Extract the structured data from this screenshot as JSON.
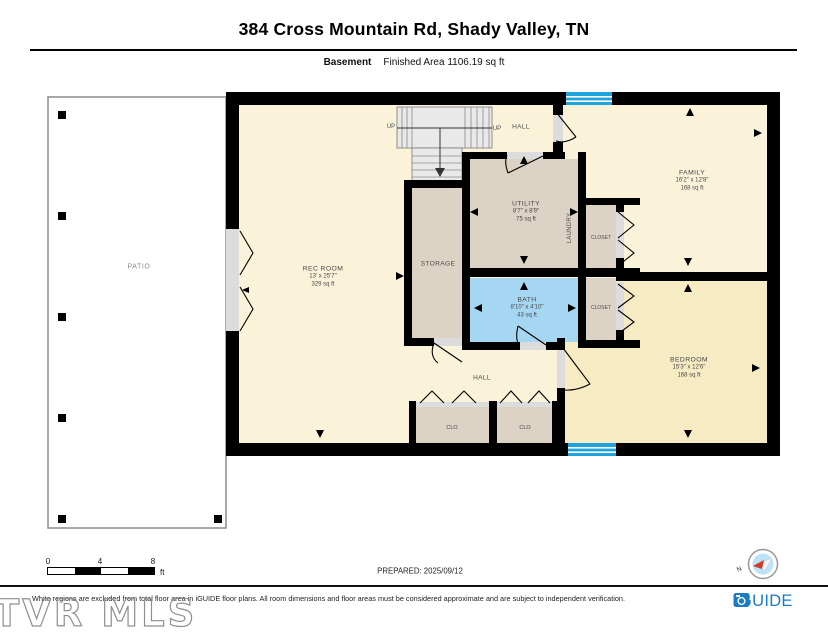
{
  "header": {
    "title": "384 Cross Mountain Rd, Shady Valley, TN",
    "floor_label": "Basement",
    "area_label": "Finished Area 1106.19 sq ft"
  },
  "rooms": {
    "patio": {
      "name": "PATIO"
    },
    "rec_room": {
      "name": "REC ROOM",
      "dims": "13' x 25'7\"",
      "area": "329 sq ft"
    },
    "storage": {
      "name": "STORAGE"
    },
    "utility": {
      "name": "UTILITY",
      "dims": "8'7\" x 8'9\"",
      "area": "75 sq ft"
    },
    "laundry": {
      "name": "LAUNDRY"
    },
    "family": {
      "name": "FAMILY",
      "dims": "16'2\" x 12'8\"",
      "area": "168 sq ft"
    },
    "bath": {
      "name": "BATH",
      "dims": "8'10\" x 4'10\"",
      "area": "43 sq ft"
    },
    "bedroom": {
      "name": "BEDROOM",
      "dims": "15'3\" x 12'6\"",
      "area": "168 sq ft"
    },
    "closet": {
      "name": "CLOSET"
    },
    "clo": {
      "name": "CLO"
    },
    "hall": {
      "name": "HALL"
    },
    "up": {
      "name": "UP"
    }
  },
  "scale": {
    "ticks": [
      "0",
      "4",
      "8"
    ],
    "unit": "ft"
  },
  "footer": {
    "prepared": "PREPARED: 2025/09/12",
    "disclaimer": "White regions are excluded from total floor area in iGUIDE floor plans. All room dimensions and floor areas must be considered approximate and are subject to independent verification.",
    "brand": "iGUIDE",
    "compass_n": "N",
    "watermark": "TVR MLS"
  },
  "colors": {
    "room_fill": "#FAF3DA",
    "bedroom_fill": "#F6EBC3",
    "closet_fill": "#DDD3C4",
    "bath_fill": "#A6D7F2",
    "stairs_fill": "#E9E9E9",
    "window": "#1FA3DC",
    "wall": "#000000",
    "brand_blue": "#1B7BC4"
  }
}
